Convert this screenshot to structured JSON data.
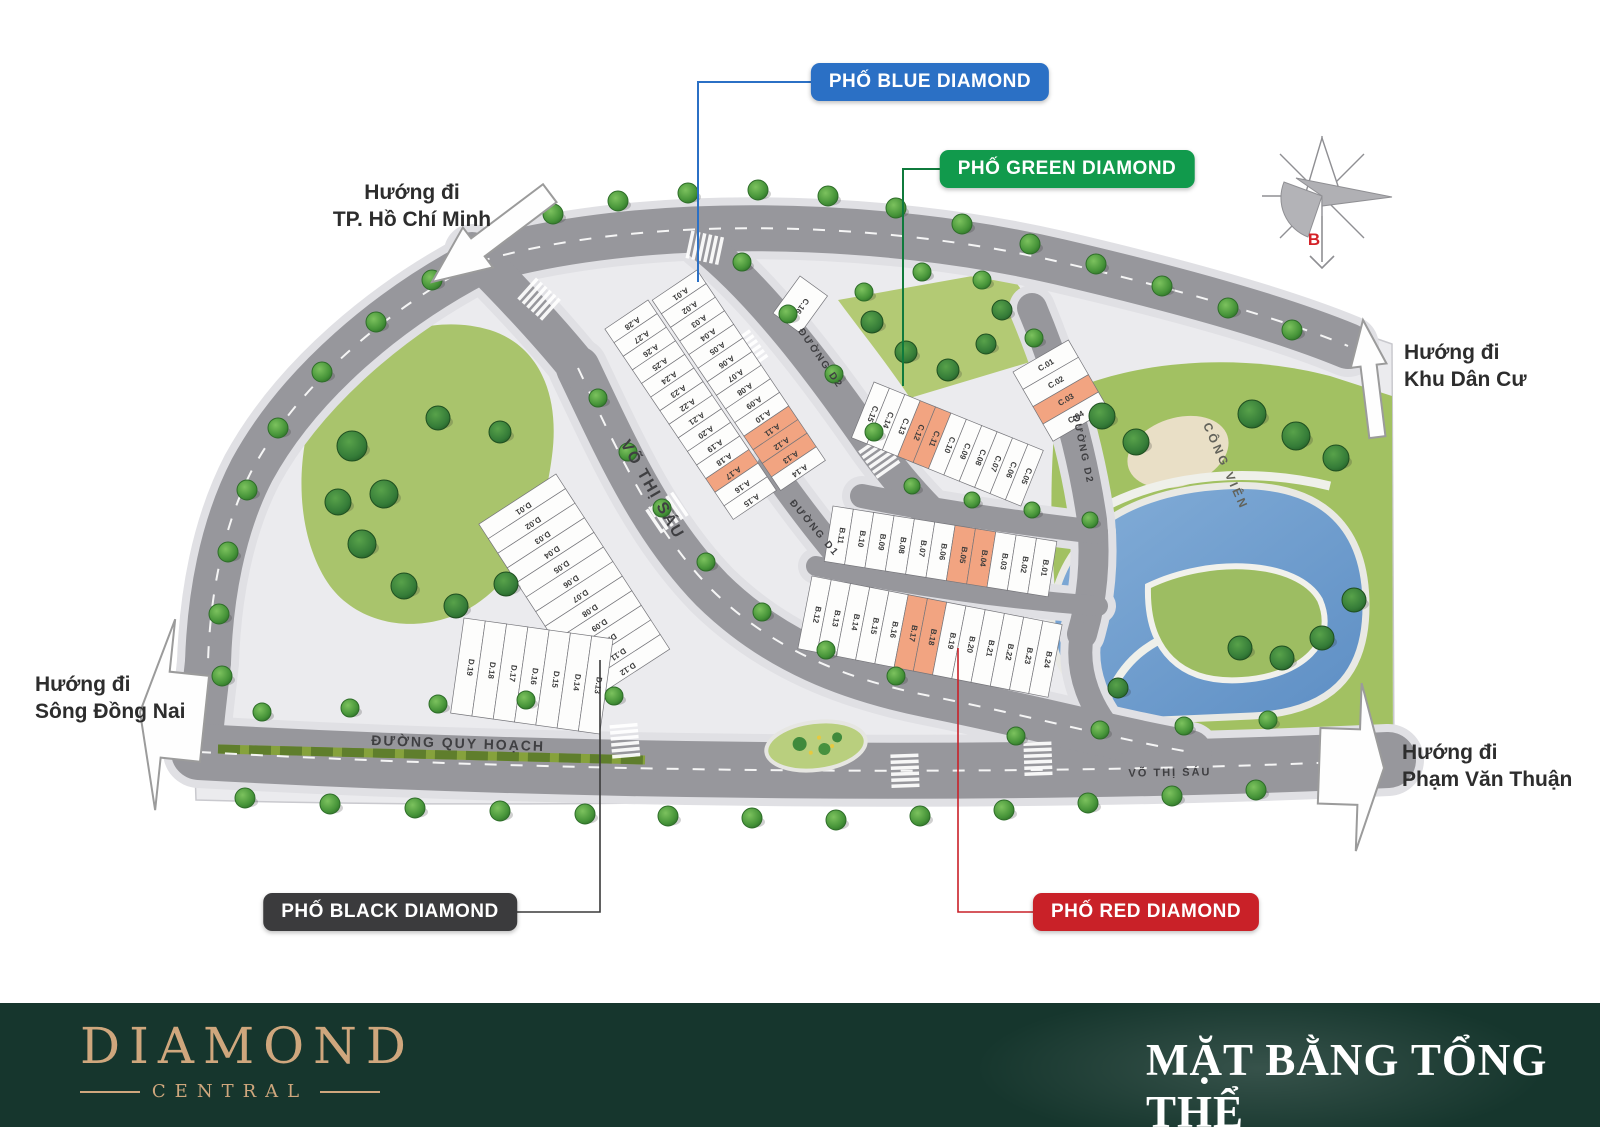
{
  "badges": {
    "blue": {
      "label": "PHỐ BLUE DIAMOND",
      "color": "#2b70c5"
    },
    "green": {
      "label": "PHỐ GREEN DIAMOND",
      "color": "#119a4c"
    },
    "black": {
      "label": "PHỐ BLACK DIAMOND",
      "color": "#3b3b3d"
    },
    "red": {
      "label": "PHỐ RED DIAMOND",
      "color": "#c92128"
    }
  },
  "directions": {
    "hcm": {
      "line1": "Hướng đi",
      "line2": "TP. Hồ Chí Minh"
    },
    "kdc": {
      "line1": "Hướng đi",
      "line2": "Khu Dân Cư"
    },
    "sdn": {
      "line1": "Hướng đi",
      "line2": "Sông Đồng Nai"
    },
    "pvt": {
      "line1": "Hướng đi",
      "line2": "Phạm Văn Thuận"
    }
  },
  "roads": {
    "vo_thi_sau_main": "VÕ THỊ SÁU",
    "vo_thi_sau_east": "VÕ THỊ SÁU",
    "duong_quy_hoach": "ĐƯỜNG QUY HOẠCH",
    "duong_d1": "ĐƯỜNG D1",
    "duong_d2_west": "ĐƯỜNG D2",
    "duong_d2_east": "ĐƯỜNG D2"
  },
  "park_label": "CÔNG VIÊN",
  "compass_label": "B",
  "lots": {
    "a_front": {
      "items": [
        "A.01",
        "A.02",
        "A.03",
        "A.04",
        "A.05",
        "A.06",
        "A.07",
        "A.08",
        "A.09",
        "A.10",
        {
          "id": "A.11",
          "hl": true
        },
        {
          "id": "A.12",
          "hl": true
        },
        {
          "id": "A.13",
          "hl": true
        },
        "A.14"
      ]
    },
    "a_back": {
      "items": [
        "A.28",
        "A.27",
        "A.26",
        "A.25",
        "A.24",
        "A.23",
        "A.22",
        "A.21",
        "A.20",
        "A.19",
        "A.18",
        {
          "id": "A.17",
          "hl": true
        },
        "A.16",
        "A.15"
      ]
    },
    "b_back": {
      "items": [
        "B.11",
        "B.10",
        "B.09",
        "B.08",
        "B.07",
        "B.06",
        {
          "id": "B.05",
          "hl": true
        },
        {
          "id": "B.04",
          "hl": true
        },
        "B.03",
        "B.02",
        "B.01"
      ]
    },
    "b_front": {
      "items": [
        "B.12",
        "B.13",
        "B.14",
        "B.15",
        "B.16",
        {
          "id": "B.17",
          "hl": true
        },
        {
          "id": "B.18",
          "hl": true
        },
        "B.19",
        "B.20",
        "B.21",
        "B.22",
        "B.23",
        "B.24"
      ]
    },
    "c_row": {
      "items": [
        "C.15",
        "C.14",
        "C.13",
        {
          "id": "C.12",
          "hl": true
        },
        {
          "id": "C.11",
          "hl": true
        },
        "C.10",
        "C.09",
        "C.08",
        "C.07",
        "C.06",
        "C.05"
      ]
    },
    "c_block": {
      "items": [
        "C.01",
        "C.02",
        {
          "id": "C.03",
          "hl": true
        },
        "C.04"
      ]
    },
    "c16": {
      "items": [
        "C.16"
      ]
    },
    "d_stairs": {
      "items": [
        "D.01",
        "D.02",
        "D.03",
        "D.04",
        "D.05",
        "D.06",
        "D.07",
        "D.08",
        "D.09",
        "D.10",
        "D.11",
        "D.12"
      ]
    },
    "d_row2": {
      "items": [
        "D.19",
        "D.18",
        "D.17",
        "D.16",
        "D.15",
        "D.14",
        "D.13"
      ]
    }
  },
  "colors": {
    "footer_bg": "#16362d",
    "brand_gold": "#cfa77d",
    "highlight_lot": "#f2a481",
    "lake": "#6f9fd0",
    "lawn": "#a9c46c",
    "road": "#97979c"
  },
  "footer": {
    "brand": "DIAMOND",
    "brand_sub": "CENTRAL",
    "title": "MẶT BẰNG TỔNG THỂ"
  }
}
